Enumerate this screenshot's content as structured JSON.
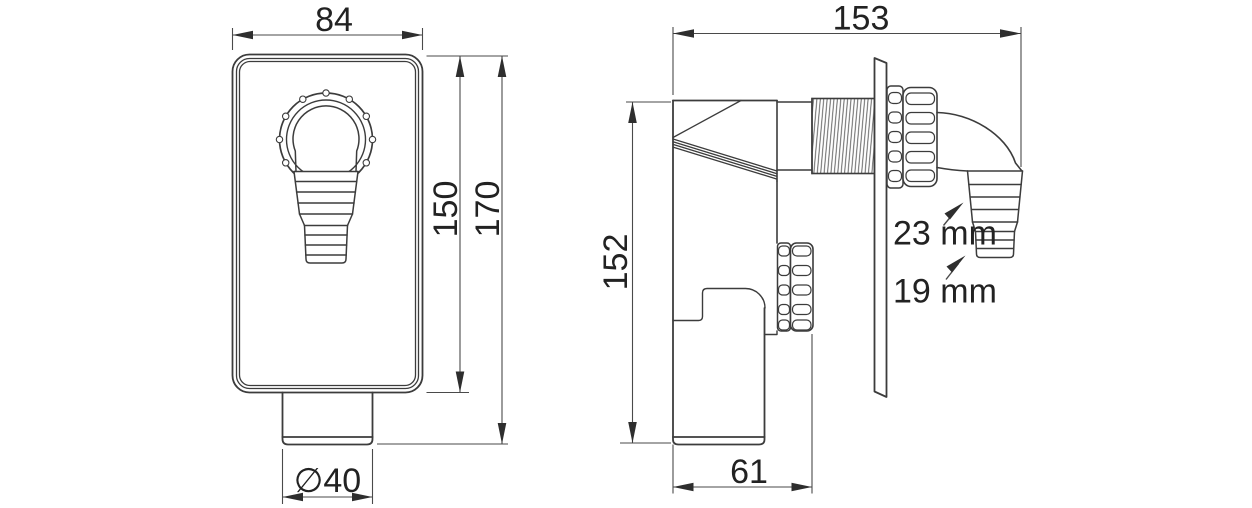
{
  "drawing": {
    "kind": "technical-dimension-drawing",
    "subject": "concealed washing machine wall trap, front and side views",
    "line_color": "#3c3c3c",
    "dim_color": "#4a4a4a",
    "text_color": "#222222",
    "background": "#ffffff",
    "front_view": {
      "dim_width": "84",
      "dim_plate_height": "150",
      "dim_total_height": "170",
      "dim_outlet_diameter": "∅40"
    },
    "side_view": {
      "dim_depth": "153",
      "dim_height": "152",
      "dim_bottom_depth": "61",
      "hose_step_large": "23 mm",
      "hose_step_small": "19 mm"
    }
  }
}
